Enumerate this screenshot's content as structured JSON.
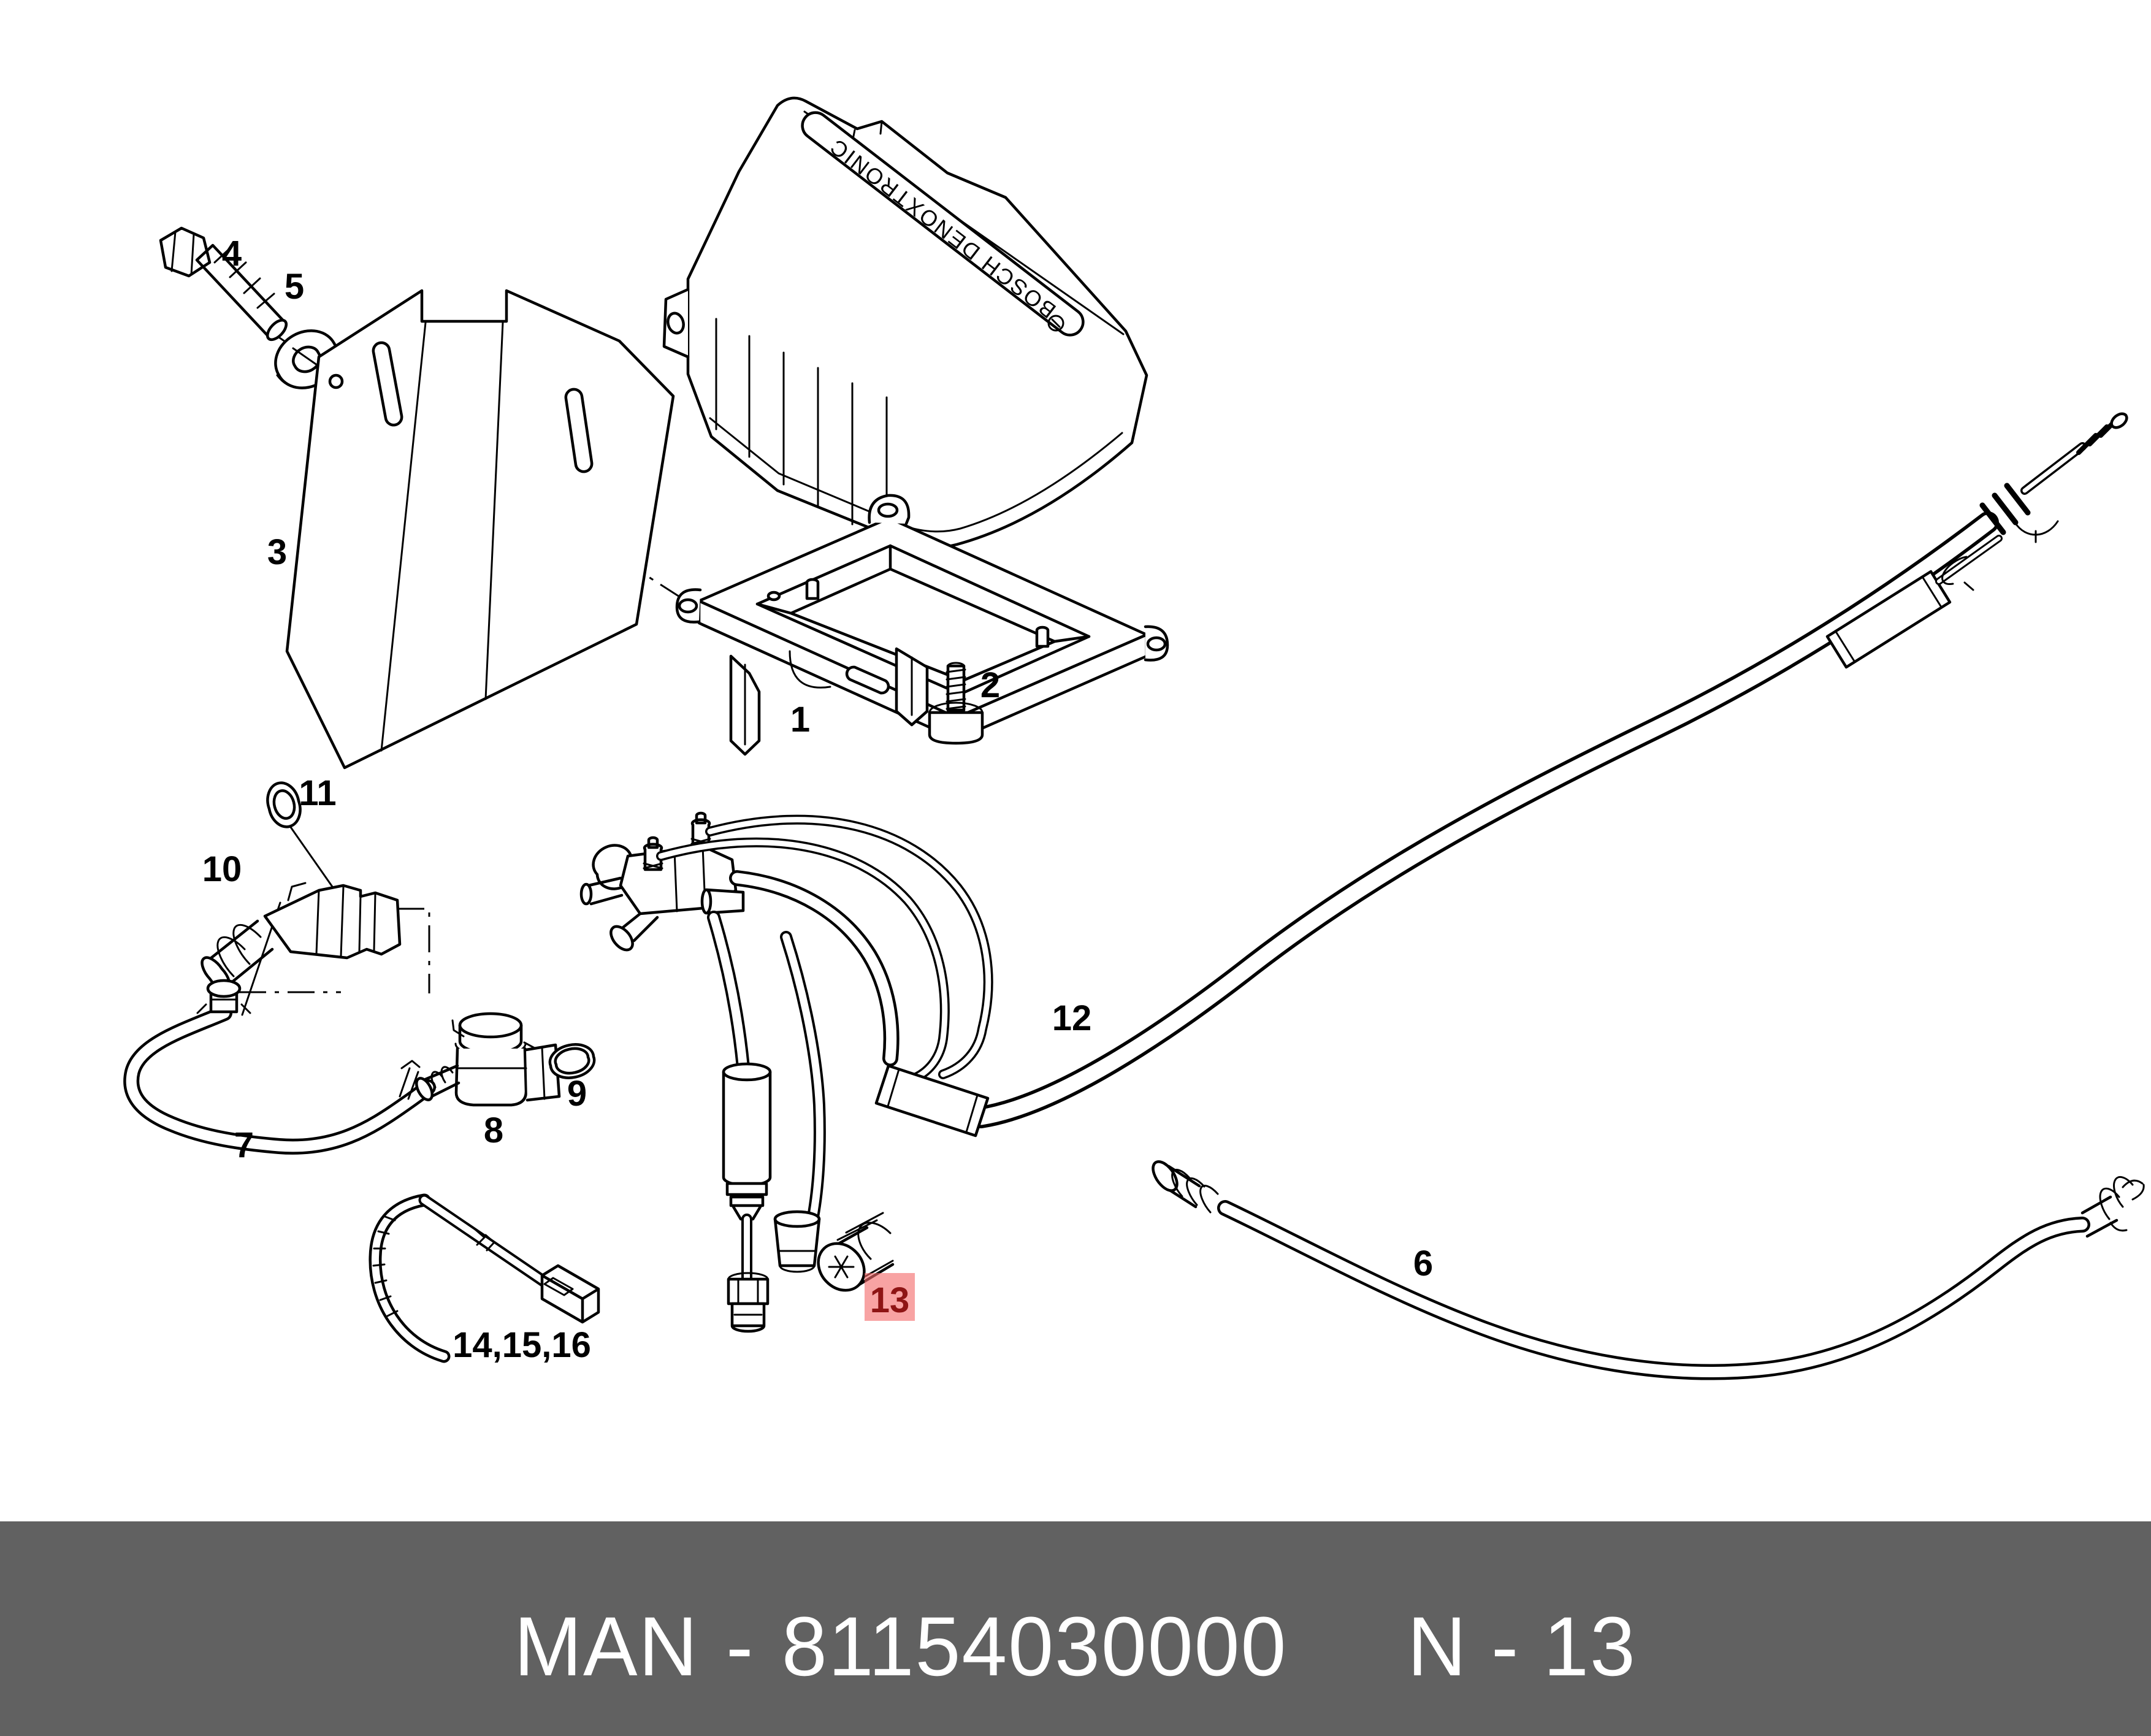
{
  "diagram": {
    "cover_text": "BOSCH DENOXTRONIC",
    "labels": [
      {
        "text": "1"
      },
      {
        "text": "2"
      },
      {
        "text": "3"
      },
      {
        "text": "4"
      },
      {
        "text": "5"
      },
      {
        "text": "6"
      },
      {
        "text": "7"
      },
      {
        "text": "8"
      },
      {
        "text": "9"
      },
      {
        "text": "10"
      },
      {
        "text": "11"
      },
      {
        "text": "12"
      },
      {
        "text": "14,15,16"
      }
    ],
    "highlight": {
      "label": "13",
      "fill": "#f46a6a",
      "text_color": "#8e1414"
    },
    "colors": {
      "line": "#000000",
      "background": "#ffffff"
    }
  },
  "footer": {
    "brand": "MAN",
    "divider": "-",
    "part_number": "81154030000",
    "page_code": "N - 13",
    "bar_color": "#616161",
    "text_color": "#ffffff"
  }
}
